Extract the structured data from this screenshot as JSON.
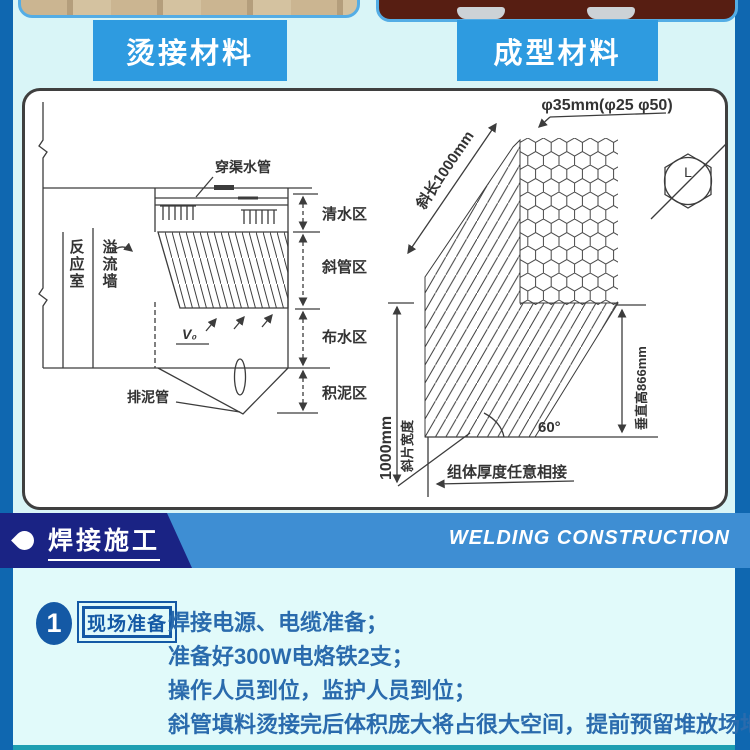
{
  "top": {
    "left_label": "烫接材料",
    "right_label": "成型材料"
  },
  "banner": {
    "title": "焊接施工",
    "subtitle": "WELDING CONSTRUCTION"
  },
  "step": {
    "number": "1",
    "tag": "现场准备",
    "lines": [
      "焊接电源、电缆准备；",
      "准备好300W电烙铁2支；",
      "操作人员到位，监护人员到位；",
      "斜管填料烫接完后体积庞大将占很大空间，提前预留堆放场地。"
    ]
  },
  "diagram": {
    "left": {
      "pipe_label": "穿渠水管",
      "zone_clear": "清水区",
      "zone_tube": "斜管区",
      "zone_distribution": "布水区",
      "zone_sludge": "积泥区",
      "reaction_room": "反应室",
      "overflow_wall": "溢流墙",
      "sludge_pipe": "排泥管",
      "v0": "V₀"
    },
    "right": {
      "diameter": "φ35mm(φ25 φ50)",
      "slant_length": "斜长1000mm",
      "sheet_width_value": "1000mm",
      "sheet_width_label": "斜片宽度",
      "vertical_height": "垂直高866mm",
      "angle": "60°",
      "module_note": "组体厚度任意相接",
      "hex_l": "L"
    }
  },
  "colors": {
    "accent_blue": "#2E9BE0",
    "navy": "#1A2384",
    "banner_blue": "#3E8ED3",
    "stripe_blue": "#0F67B0",
    "step_blue": "#1459A5",
    "text_blue": "#2A6BAD",
    "bg_cyan": "#D9F5F7",
    "bottom_strip": "#1E9FB2"
  }
}
